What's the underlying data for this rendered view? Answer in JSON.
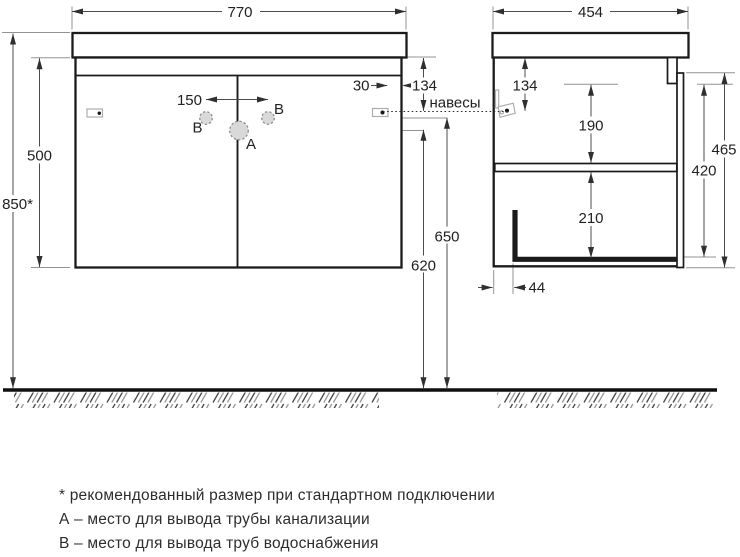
{
  "dims_front": {
    "width": "770",
    "height_total": "850*",
    "height_cabinet": "500",
    "faucet_spacing": "150",
    "hanger_side_offset": "30",
    "hanger_top_offset": "134",
    "height_water_supply": "650",
    "height_drain": "620"
  },
  "dims_side": {
    "depth": "454",
    "hanger_top_offset": "134",
    "upper_section": "190",
    "height_front": "465",
    "height_body": "420",
    "lower_section": "210",
    "back_clearance": "44"
  },
  "labels": {
    "hangers": "навесы",
    "point_a": "А",
    "point_b": "В"
  },
  "notes": {
    "asterisk": "* рекомендованный размер при стандартном подключении",
    "point_a": "А – место для вывода трубы канализации",
    "point_b": "В – место для вывода труб водоснабжения"
  }
}
